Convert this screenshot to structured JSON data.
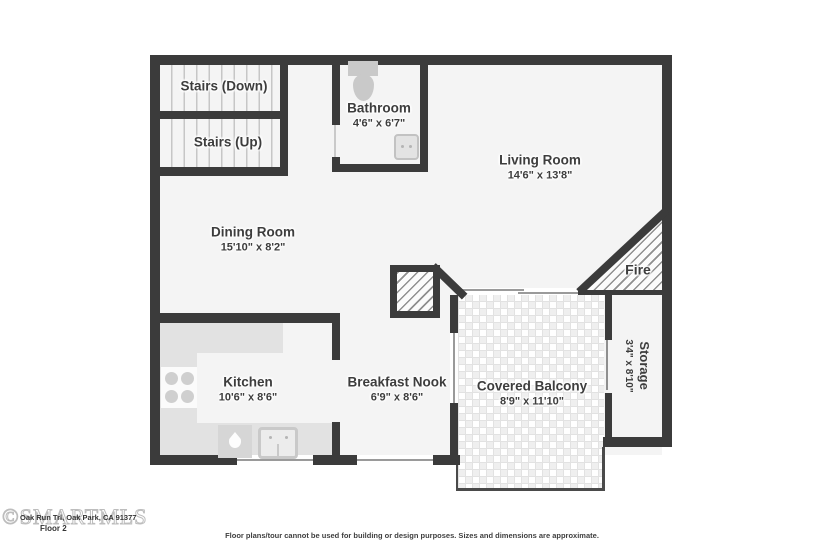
{
  "rooms": {
    "stairs_down": {
      "label": "Stairs (Down)"
    },
    "stairs_up": {
      "label": "Stairs (Up)"
    },
    "bathroom": {
      "label": "Bathroom",
      "dims": "4'6\" x 6'7\""
    },
    "living_room": {
      "label": "Living Room",
      "dims": "14'6\" x 13'8\""
    },
    "dining_room": {
      "label": "Dining Room",
      "dims": "15'10\" x 8'2\""
    },
    "kitchen": {
      "label": "Kitchen",
      "dims": "10'6\" x 8'6\""
    },
    "breakfast_nook": {
      "label": "Breakfast Nook",
      "dims": "6'9\" x 8'6\""
    },
    "covered_balcony": {
      "label": "Covered Balcony",
      "dims": "8'9\" x 11'10\""
    },
    "storage": {
      "label": "Storage",
      "dims": "3'4\" x 8'10\""
    },
    "fireplace": {
      "label": "Fire"
    }
  },
  "footer": {
    "watermark": "©SMARTMLS",
    "address": "Oak Run Trl, Oak Park, CA 91377",
    "floor": "Floor 2",
    "disclaimer": "Floor plans/tour cannot be used for building or design purposes. Sizes and dimensions are approximate."
  },
  "colors": {
    "wall": "#3b3b3b",
    "room_fill": "#f4f4f4",
    "counter": "#e2e2e2",
    "fixture": "#c9c9c9"
  }
}
